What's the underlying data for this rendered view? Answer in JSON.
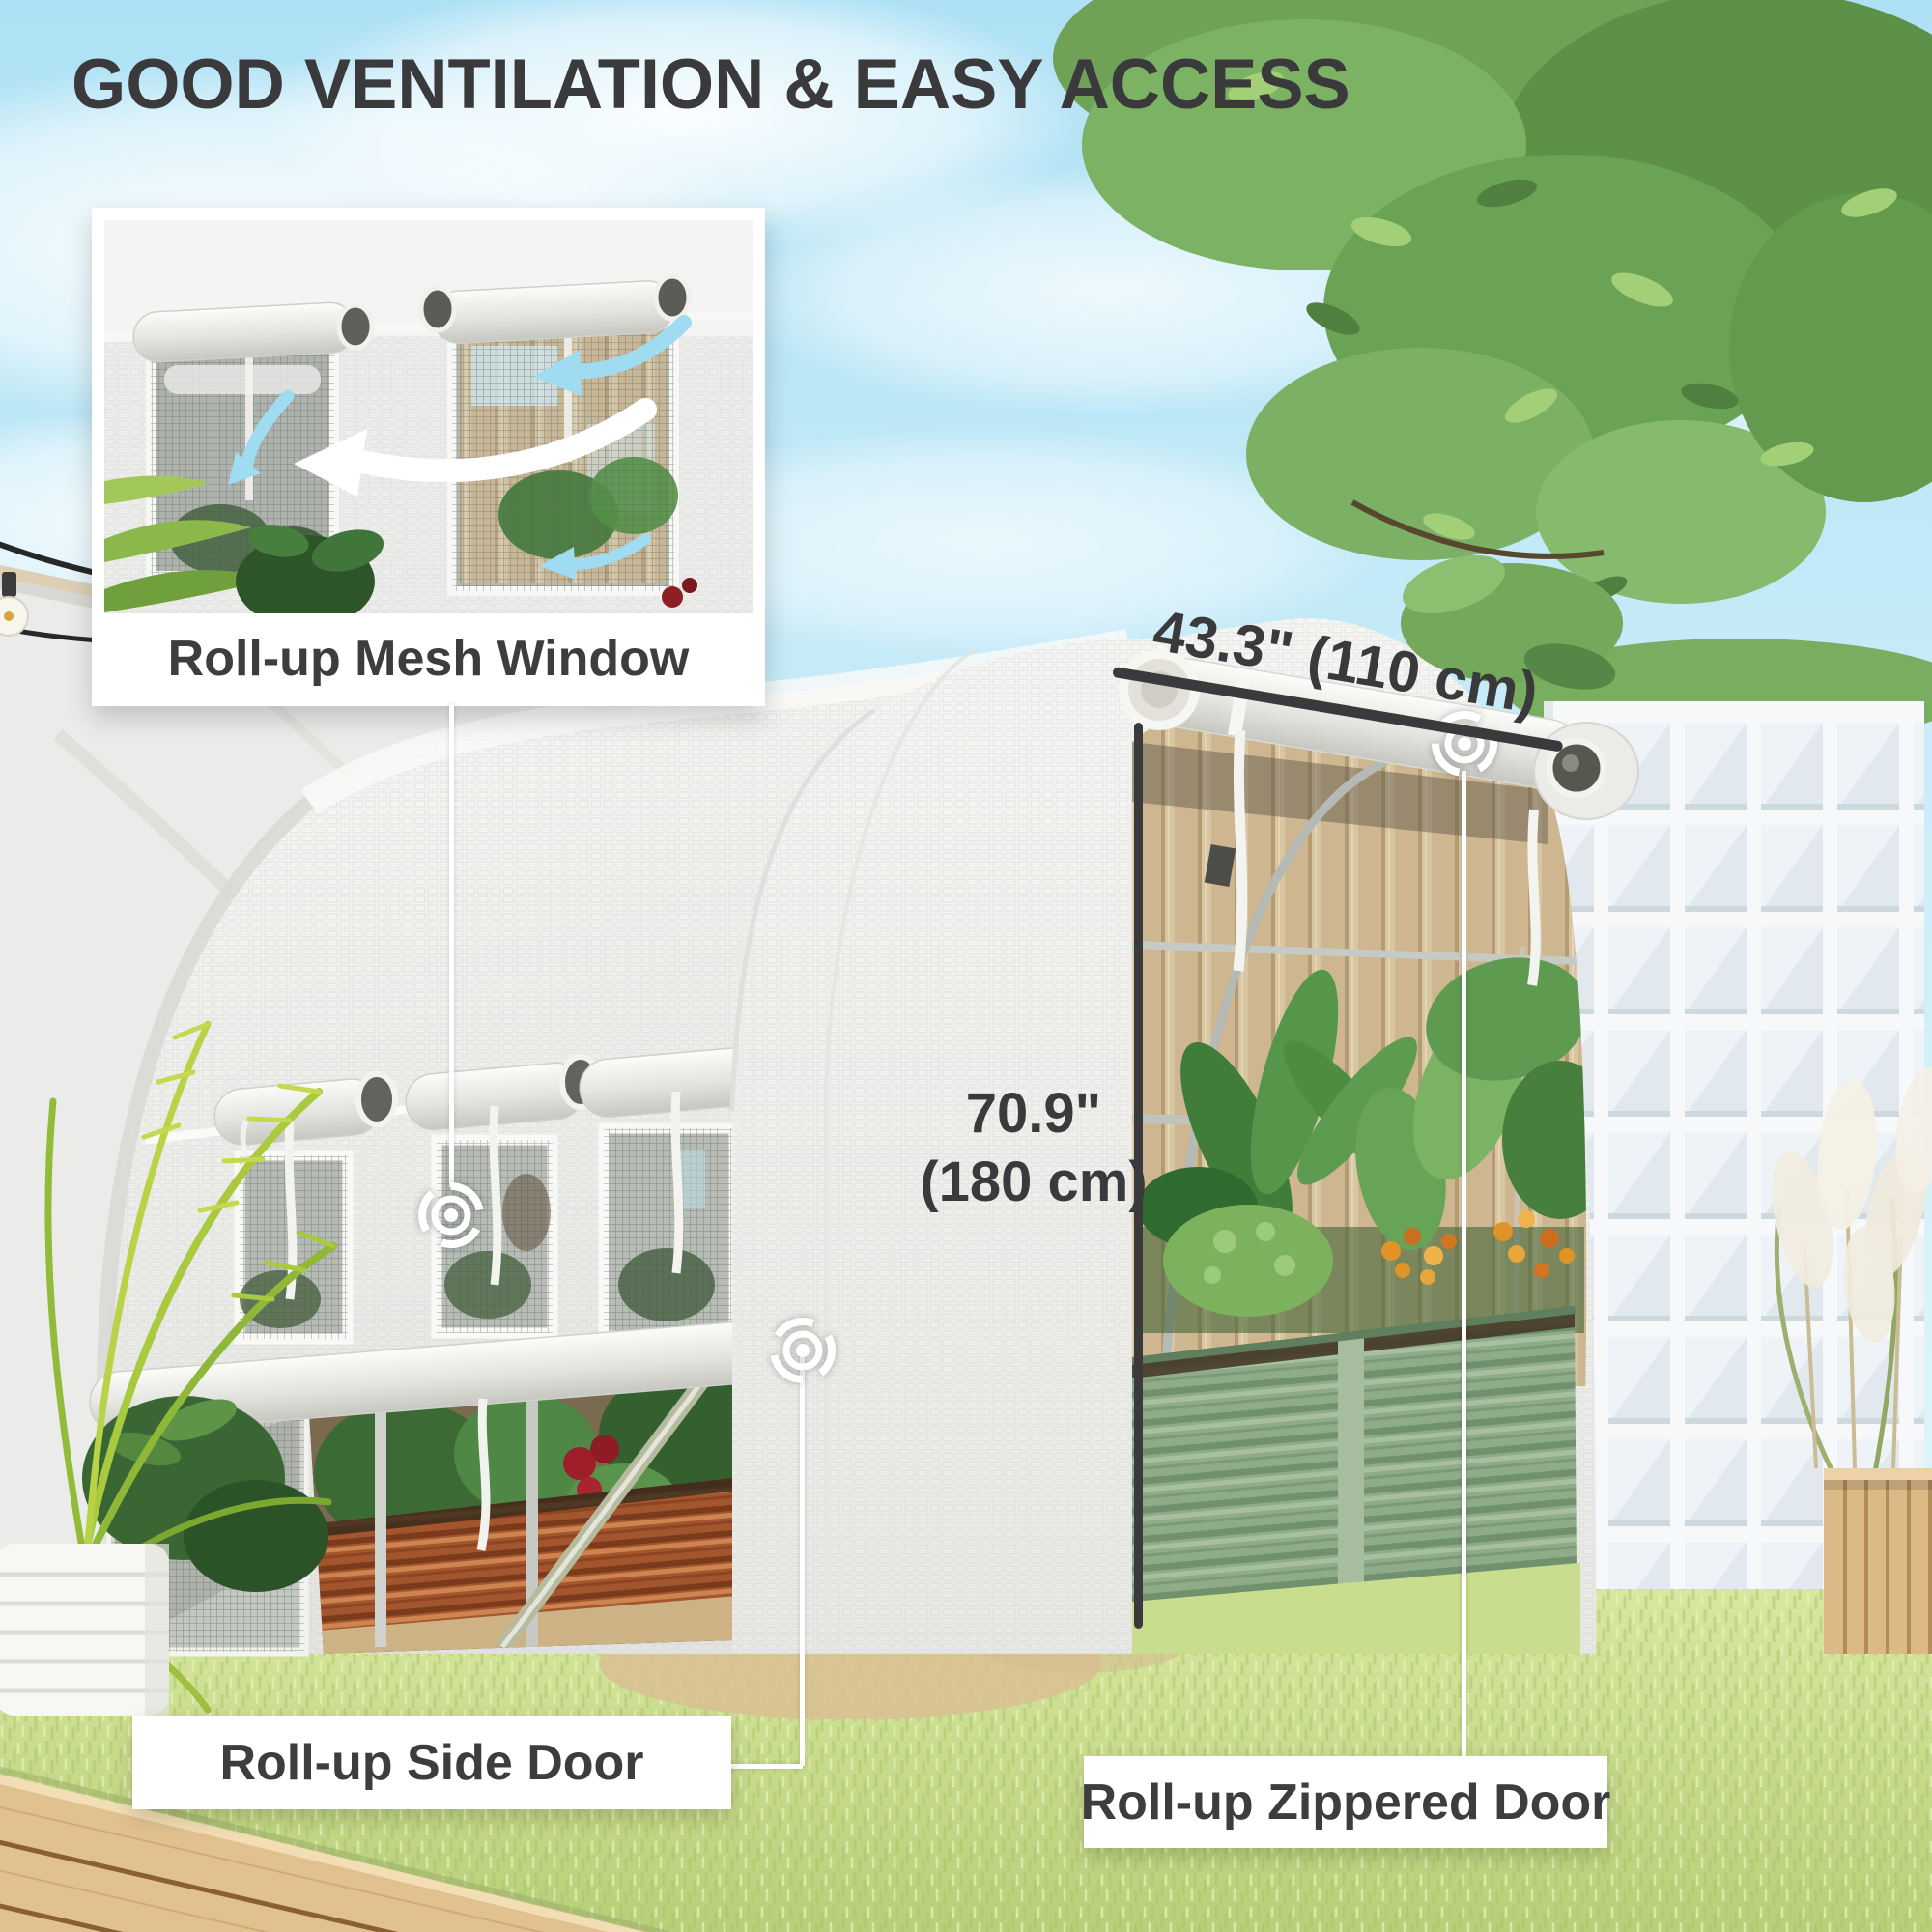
{
  "page": {
    "title": "GOOD VENTILATION & EASY ACCESS"
  },
  "callouts": {
    "mesh_window": {
      "label": "Roll-up Mesh Window"
    },
    "side_door": {
      "label": "Roll-up Side Door"
    },
    "zippered_door": {
      "label": "Roll-up Zippered Door"
    }
  },
  "dimensions": {
    "door_width": "43.3\" (110 cm)",
    "door_height_line1": "70.9\"",
    "door_height_line2": "(180 cm)"
  },
  "icons": {
    "window_marker": "target-icon",
    "side_door_marker": "target-icon",
    "zipper_marker": "target-icon",
    "airflow": "curved-arrow-icon"
  },
  "colors": {
    "title_text": "#3A3A3C",
    "label_text": "#3D3D40",
    "label_bg": "#FFFFFF",
    "dimension_line": "#3A3A3C",
    "airflow_arrow": "#9FDCF2",
    "greenhouse_cover": "#F1F1EF",
    "planter_green": "#8FAC88",
    "planter_copper": "#A3552D",
    "grass": "#C4D986",
    "sky": "#BCE7F6"
  }
}
